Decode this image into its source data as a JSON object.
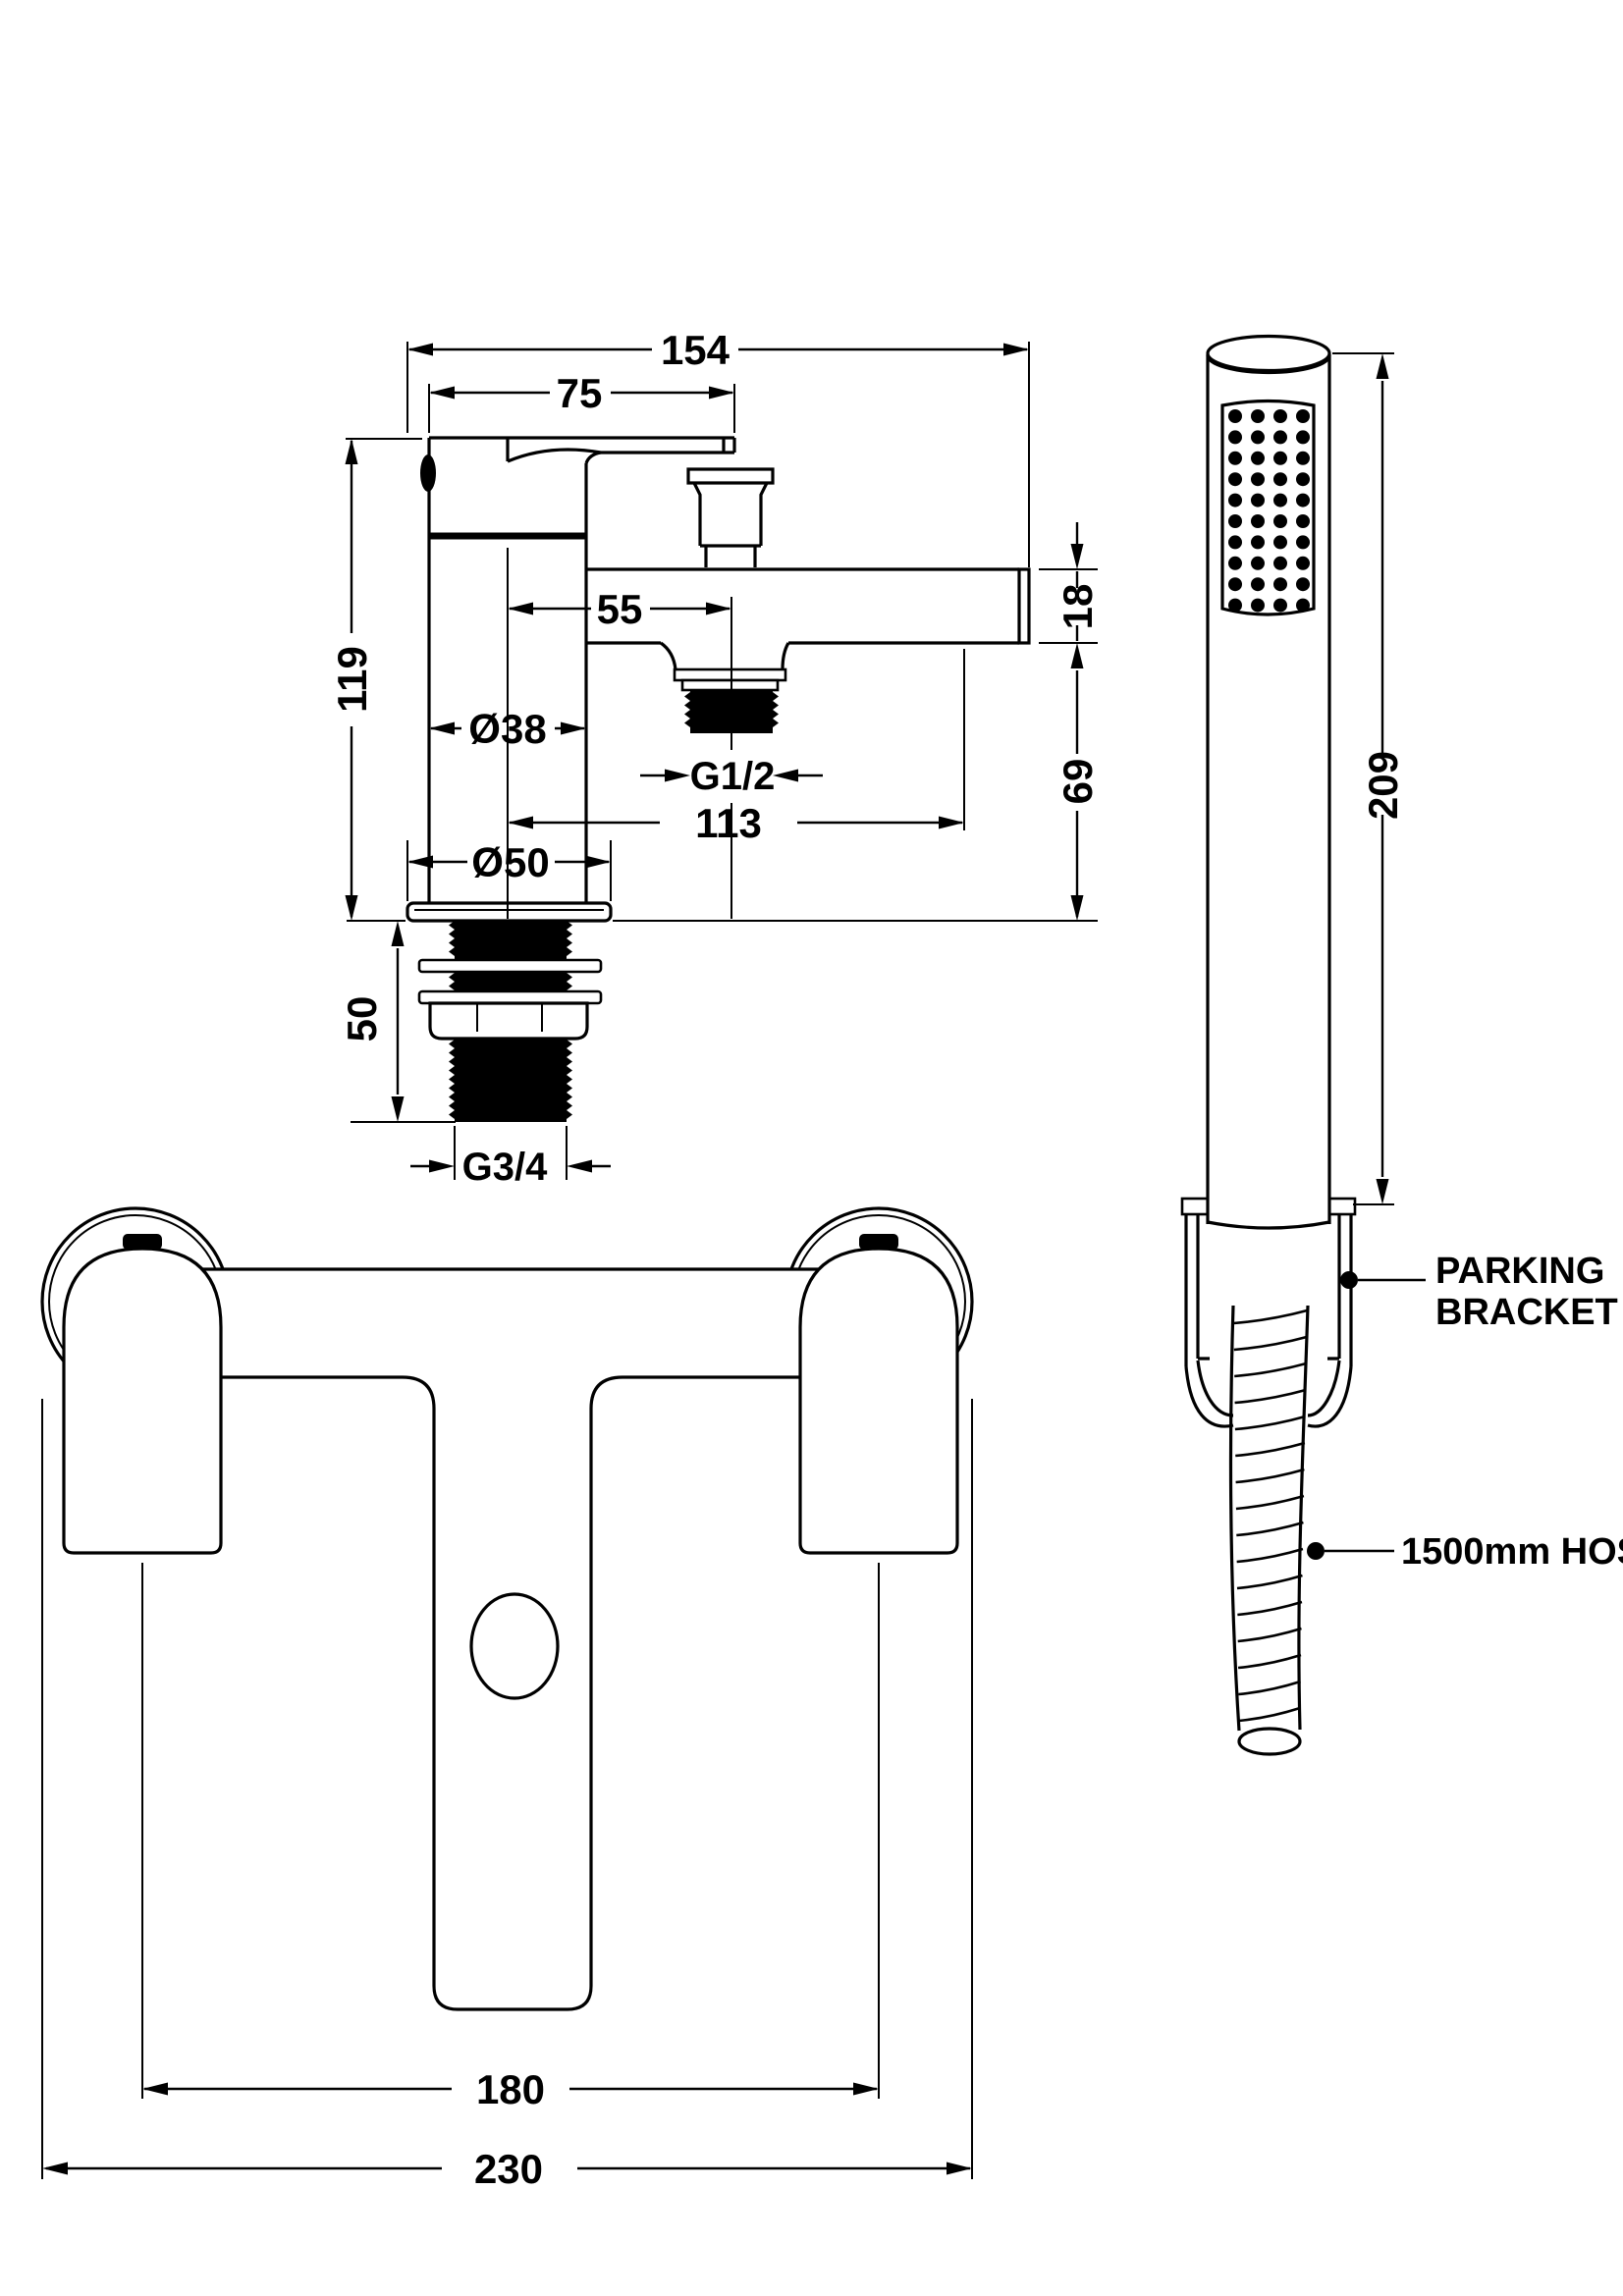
{
  "canvas": {
    "background": "#ffffff",
    "line_color": "#000000"
  },
  "side_view": {
    "dims": {
      "projection": "154",
      "lever": "75",
      "height": "119",
      "outlet_offset": "55",
      "body_dia": "Ø38",
      "outlet_thread": "G1/2",
      "reach": "113",
      "base_dia": "Ø50",
      "shank_len": "50",
      "shank_thread": "G3/4",
      "spout_depth": "18",
      "clearance": "69"
    }
  },
  "handset_view": {
    "dims": {
      "length": "209"
    },
    "labels": {
      "bracket_line1": "PARKING",
      "bracket_line2": "BRACKET",
      "hose": "1500mm HOSE"
    },
    "spray_grid": {
      "cols": 4,
      "rows": 10
    }
  },
  "front_view": {
    "dims": {
      "hole_centres": "180",
      "overall_width": "230"
    }
  }
}
